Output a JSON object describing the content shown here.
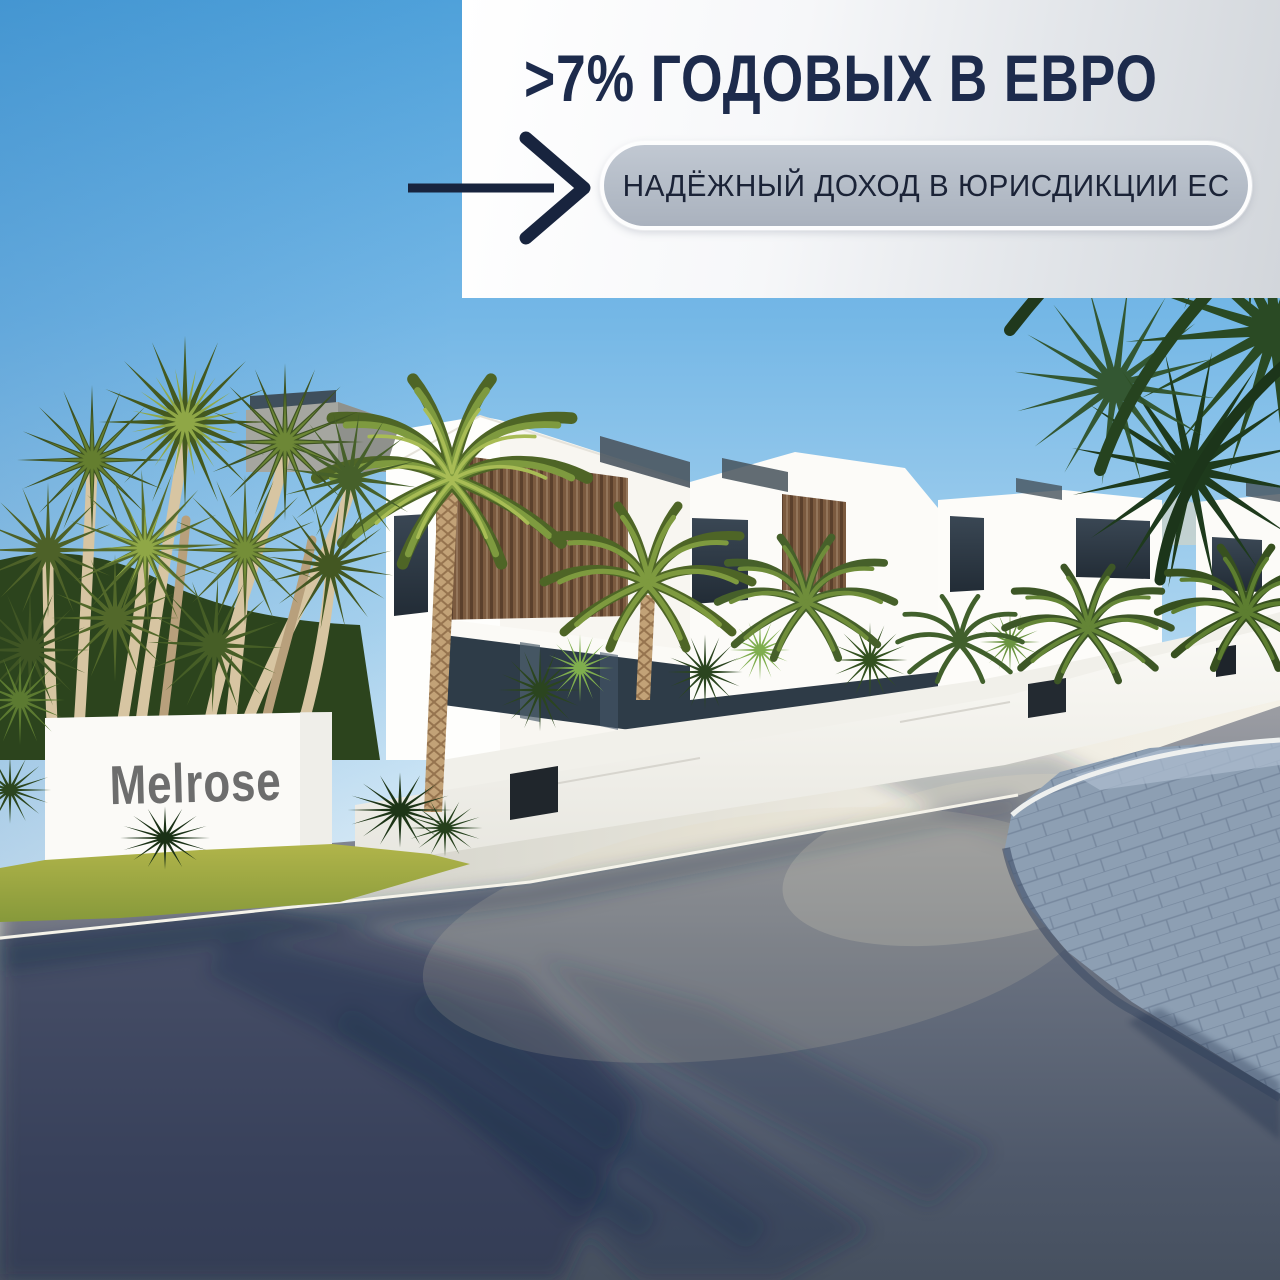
{
  "banner": {
    "headline": ">7% ГОДОВЫХ В ЕВРО",
    "cta_label": "НАДЁЖНЫЙ ДОХОД В ЮРИСДИКЦИИ ЕС",
    "arrow_icon": "arrow-right-icon",
    "colors": {
      "text_navy": "#1d2b4c",
      "panel_light": "#ffffff",
      "panel_shade": "#d2d6db",
      "pill_fill_top": "#c1c8d2",
      "pill_fill_bottom": "#aab2be",
      "pill_border": "#ffffff",
      "arrow_navy": "#18243e"
    }
  },
  "scene": {
    "sign_text": "Melrose",
    "sign_text_color": "#6d6d6d",
    "colors": {
      "sky_top": "#4fa1da",
      "sky_horizon": "#e4f2fa",
      "building_white": "#fdfdfb",
      "wood_slats": "#7b5a3f",
      "window_glass": "#2e3944",
      "palm_green": "#7e9a3f",
      "grass": "#a9ad45",
      "asphalt": "#5c6575",
      "paver_walkway": "#93a6bf",
      "sidewalk": "#dddcd4"
    }
  }
}
